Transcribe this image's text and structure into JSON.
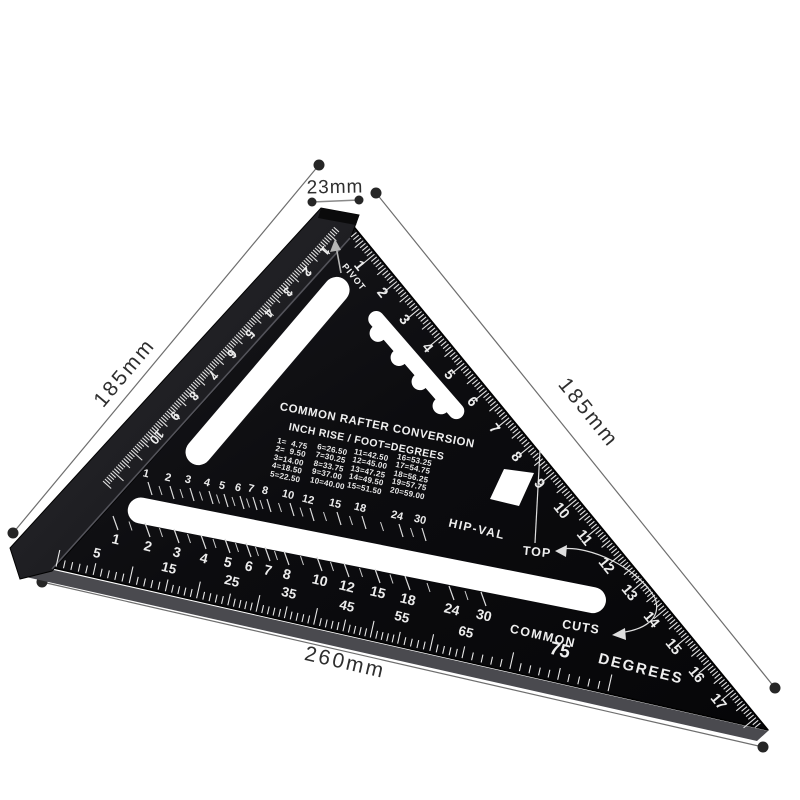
{
  "colors": {
    "background": "#ffffff",
    "plate": "#0d0d10",
    "lip": "#202024",
    "marking": "#efefef",
    "dimension_line": "#6e6e6e",
    "dot": "#262626"
  },
  "dimensions": {
    "top": "23mm",
    "left": "185mm",
    "right": "185mm",
    "bottom": "260mm"
  },
  "square": {
    "pivot_label": "PIVOT",
    "top_label": "TOP",
    "cuts_label": "CUTS",
    "hip_val_label": "HIP-VAL",
    "common_label": "COMMON",
    "degrees_label": "DEGREES",
    "degrees_big_value": "75",
    "table": {
      "title": "COMMON RAFTER CONVERSION",
      "subtitle": "INCH RISE / FOOT=DEGREES",
      "columns": [
        [
          "1=  4.75",
          "2=  9.50",
          "3=14.00",
          "4=18.50",
          "5=22.50"
        ],
        [
          "6=26.50",
          "7=30.25",
          "8=33.75",
          "9=37.00",
          "10=40.00"
        ],
        [
          "11=42.50",
          "12=45.00",
          "13=47.25",
          "14=49.50",
          "15=51.50"
        ],
        [
          "16=53.25",
          "17=54.75",
          "18=56.25",
          "19=57.75",
          "20=59.00"
        ]
      ]
    },
    "scales": {
      "hypotenuse_cm": [
        "1",
        "2",
        "3",
        "4",
        "5",
        "6",
        "7",
        "8",
        "9",
        "10",
        "11",
        "12",
        "13",
        "14",
        "15",
        "16",
        "17"
      ],
      "left_edge_cm": [
        "1",
        "2",
        "3",
        "4",
        "5",
        "6",
        "7",
        "8",
        "9",
        "10"
      ],
      "hip_val_row": [
        [
          "1",
          146,
          474
        ],
        [
          "2",
          168,
          478
        ],
        [
          "3",
          188,
          480
        ],
        [
          "4",
          207,
          483
        ],
        [
          "5",
          222,
          486
        ],
        [
          "6",
          238,
          488
        ],
        [
          "7",
          251,
          489
        ],
        [
          "8",
          265,
          491
        ],
        [
          "10",
          288,
          495
        ],
        [
          "12",
          308,
          500
        ],
        [
          "15",
          335,
          504
        ],
        [
          "18",
          360,
          508
        ],
        [
          "24",
          397,
          516
        ],
        [
          "30",
          420,
          520
        ]
      ],
      "common_row": [
        [
          "1",
          116,
          539
        ],
        [
          "2",
          148,
          546
        ],
        [
          "3",
          177,
          552
        ],
        [
          "4",
          204,
          558
        ],
        [
          "5",
          228,
          562
        ],
        [
          "6",
          249,
          566
        ],
        [
          "7",
          268,
          570
        ],
        [
          "8",
          287,
          574
        ],
        [
          "10",
          320,
          580
        ],
        [
          "12",
          347,
          586
        ],
        [
          "15",
          378,
          592
        ],
        [
          "18",
          408,
          599
        ],
        [
          "24",
          452,
          609
        ],
        [
          "30",
          484,
          615
        ]
      ],
      "degrees_row": [
        [
          "5",
          97,
          553
        ],
        [
          "15",
          169,
          568
        ],
        [
          "25",
          232,
          581
        ],
        [
          "35",
          289,
          593
        ],
        [
          "45",
          347,
          606
        ],
        [
          "55",
          402,
          617
        ],
        [
          "65",
          466,
          632
        ]
      ]
    }
  }
}
